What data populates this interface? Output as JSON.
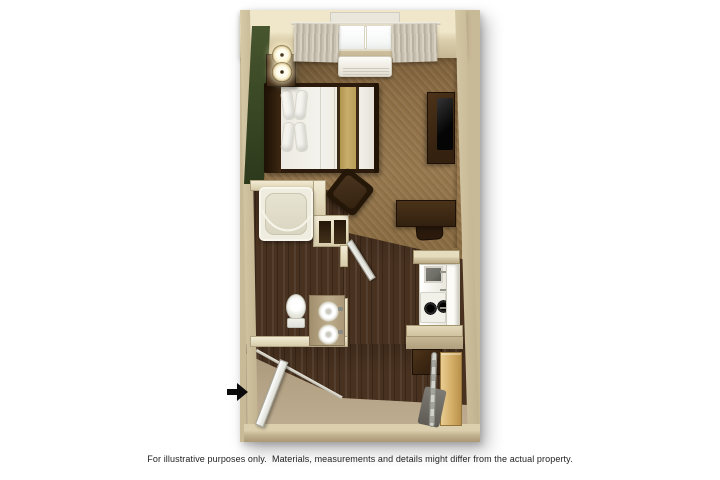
{
  "caption": "For illustrative purposes only.  Materials, measurements and details might differ from the actual property.",
  "floor_plan": {
    "unit_type": "studio",
    "rooms": [
      "bedroom-living-area",
      "bathroom",
      "closet",
      "kitchenette",
      "entry"
    ],
    "features": [
      "window-with-curtains",
      "wall-ac-unit",
      "bed",
      "nightstand",
      "two-table-lamps",
      "tv-dresser",
      "television",
      "armchair",
      "desk",
      "desk-chair",
      "bathtub-with-curtain-rod",
      "toilet",
      "vanity-with-two-basins",
      "shelf-closet",
      "kitchen-sink",
      "two-burner-stove",
      "refrigerator",
      "kitchen-counters",
      "base-cabinet",
      "wardrobe-cabinet",
      "ironing-board",
      "entry-door",
      "bathroom-door",
      "entry-direction-arrow"
    ]
  },
  "icons": {
    "entry_arrow": "solid-right-arrow"
  },
  "colors": {
    "page_bg": "#ffffff",
    "wall_outer": "#c8b997",
    "wall_cream": "#e4dbbd",
    "accent_green": "#47562e",
    "accent_green_dark": "#2c3a1c",
    "carpet": "#8d6f46",
    "wood": "#48311f",
    "entry_carpet": "#b3a184",
    "counter": "#d6caa9",
    "dark_wood_furniture": "#34210f",
    "bedding_white": "#f4f2ec",
    "runner_tan": "#c8ad6a",
    "appliance_white": "#e9e7dd",
    "fridge_white": "#fcfbf7",
    "oak": "#d4ad66",
    "sink_dark": "#6e6e67",
    "curtain": "#b8b0a1",
    "glass_white": "#f6f8f7",
    "door_white": "#f2f2ee",
    "arrow_black": "#0b0b0b",
    "caption_color": "#1e1e1e"
  }
}
